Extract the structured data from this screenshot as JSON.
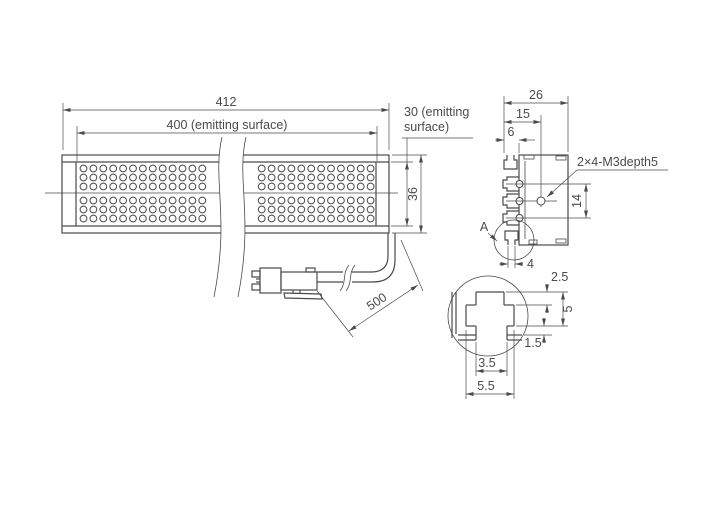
{
  "front_view": {
    "dim_overall_length": "412",
    "dim_emitting_length": "400 (emitting surface)",
    "emitting_note_1": "30 (emitting",
    "emitting_note_2": "surface)",
    "dim_height": "36",
    "dim_cable_length": "500",
    "led_grid": {
      "rows": 6,
      "columns": 30
    }
  },
  "section_view": {
    "dim_width": "26",
    "dim_inner": "15",
    "dim_groove": "6",
    "dim_pitch": "14",
    "dim_slot": "4",
    "hole_note": "2×4-M3depth5",
    "detail_label": "A"
  },
  "detail_view": {
    "dim_wall": "2.5",
    "dim_depth": "5",
    "dim_lip": "1.5",
    "dim_mouth": "3.5",
    "dim_outer": "5.5"
  },
  "colors": {
    "line": "#4a4a4a",
    "background": "#ffffff"
  }
}
